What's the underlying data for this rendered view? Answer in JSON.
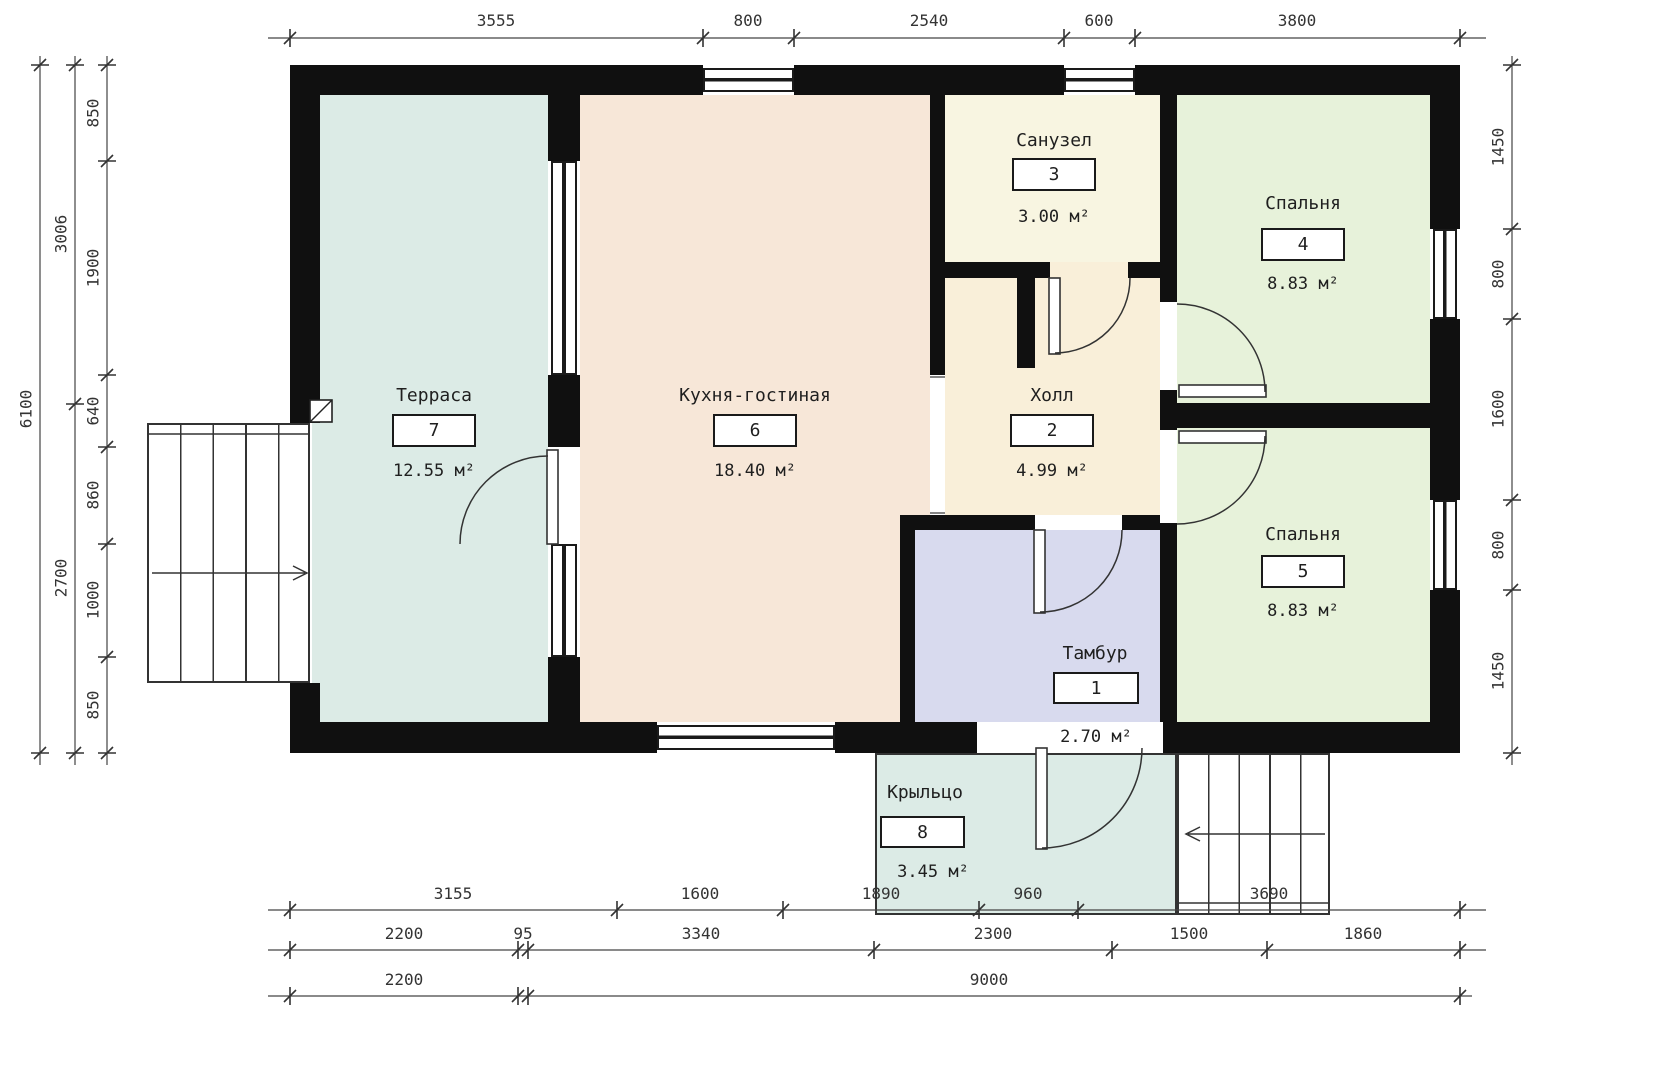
{
  "drawing_type": "floor-plan",
  "rooms": [
    {
      "name": "Терраса",
      "number": "7",
      "area": "12.55 м²"
    },
    {
      "name": "Кухня-гостиная",
      "number": "6",
      "area": "18.40 м²"
    },
    {
      "name": "Санузел",
      "number": "3",
      "area": "3.00 м²"
    },
    {
      "name": "Холл",
      "number": "2",
      "area": "4.99 м²"
    },
    {
      "name": "Спальня",
      "number": "4",
      "area": "8.83 м²"
    },
    {
      "name": "Спальня",
      "number": "5",
      "area": "8.83 м²"
    },
    {
      "name": "Тамбур",
      "number": "1",
      "area": "2.70 м²"
    },
    {
      "name": "Крыльцо",
      "number": "8",
      "area": "3.45 м²"
    }
  ],
  "dimensions": {
    "top": [
      "3555",
      "800",
      "2540",
      "600",
      "3800"
    ],
    "left_inner": [
      "850",
      "1900",
      "640",
      "860",
      "1000",
      "850"
    ],
    "left_mid": [
      "3006",
      "2700"
    ],
    "left_outer": [
      "6100"
    ],
    "right": [
      "1450",
      "800",
      "1600",
      "800",
      "1450"
    ],
    "bottom_row1": [
      "3155",
      "1600",
      "1890",
      "960",
      "3690"
    ],
    "bottom_row2": [
      "2200",
      "95",
      "3340",
      "2300",
      "1500",
      "1860"
    ],
    "bottom_row3": [
      "2200",
      "9000"
    ]
  },
  "colors": {
    "terrace": "#dcebe6",
    "porch": "#dcebe6",
    "kitchen_living": "#f7e7d8",
    "bathroom": "#f8f5e1",
    "hall": "#f9efd9",
    "bedroom": "#e7f2da",
    "vestibule": "#d8daee",
    "walls": "#101010",
    "linework": "#333333"
  }
}
